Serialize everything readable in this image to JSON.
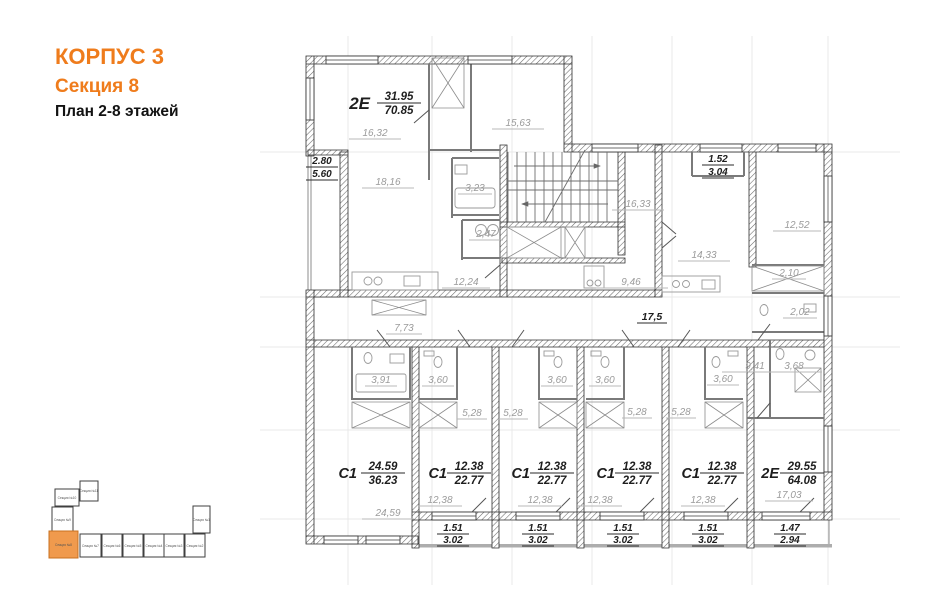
{
  "title": {
    "building": "КОРПУС 3",
    "section": "Секция 8",
    "plan": "План 2-8 этажей"
  },
  "colors": {
    "accent": "#EF7C1C",
    "minimap_highlight": "#F09A4D",
    "room_label": "#9b9b9b"
  },
  "apartments": [
    {
      "type": "2Е",
      "living_area": "31.95",
      "total_area": "70.85"
    },
    {
      "type": "С1",
      "living_area": "24.59",
      "total_area": "36.23"
    },
    {
      "type": "С1",
      "living_area": "12.38",
      "total_area": "22.77"
    },
    {
      "type": "С1",
      "living_area": "12.38",
      "total_area": "22.77"
    },
    {
      "type": "С1",
      "living_area": "12.38",
      "total_area": "22.77"
    },
    {
      "type": "С1",
      "living_area": "12.38",
      "total_area": "22.77"
    },
    {
      "type": "2Е",
      "living_area": "29.55",
      "total_area": "64.08"
    }
  ],
  "balconies": [
    {
      "a": "2.80",
      "b": "5.60"
    },
    {
      "a": "1.52",
      "b": "3.04"
    },
    {
      "a": "1.51",
      "b": "3.02"
    },
    {
      "a": "1.51",
      "b": "3.02"
    },
    {
      "a": "1.51",
      "b": "3.02"
    },
    {
      "a": "1.51",
      "b": "3.02"
    },
    {
      "a": "1.47",
      "b": "2.94"
    }
  ],
  "common": {
    "corridor_area": "17,5"
  },
  "rooms": [
    {
      "area": "16,32"
    },
    {
      "area": "15,63"
    },
    {
      "area": "18,16"
    },
    {
      "area": "3,23"
    },
    {
      "area": "2,47"
    },
    {
      "area": "12,24"
    },
    {
      "area": "7,73"
    },
    {
      "area": "16,33"
    },
    {
      "area": "14,33"
    },
    {
      "area": "12,52"
    },
    {
      "area": "2,10"
    },
    {
      "area": "2,02"
    },
    {
      "area": "9,46"
    },
    {
      "area": "9,41"
    },
    {
      "area": "3,68"
    },
    {
      "area": "3,91"
    },
    {
      "area": "3,60"
    },
    {
      "area": "3,60"
    },
    {
      "area": "3,60"
    },
    {
      "area": "3,60"
    },
    {
      "area": "5,28"
    },
    {
      "area": "5,28"
    },
    {
      "area": "5,28"
    },
    {
      "area": "5,28"
    },
    {
      "area": "24,59"
    },
    {
      "area": "12,38"
    },
    {
      "area": "12,38"
    },
    {
      "area": "12,38"
    },
    {
      "area": "12,38"
    },
    {
      "area": "17,03"
    }
  ],
  "minimap": {
    "sections": [
      {
        "name": "Секция №11"
      },
      {
        "name": "Секция №10"
      },
      {
        "name": "Секция №9"
      },
      {
        "name": "Секция №8"
      },
      {
        "name": "Секция №7"
      },
      {
        "name": "Секция №6"
      },
      {
        "name": "Секция №5"
      },
      {
        "name": "Секция №4"
      },
      {
        "name": "Секция №3"
      },
      {
        "name": "Секция №2"
      },
      {
        "name": "Секция №1"
      }
    ],
    "highlighted": "Секция №8"
  }
}
